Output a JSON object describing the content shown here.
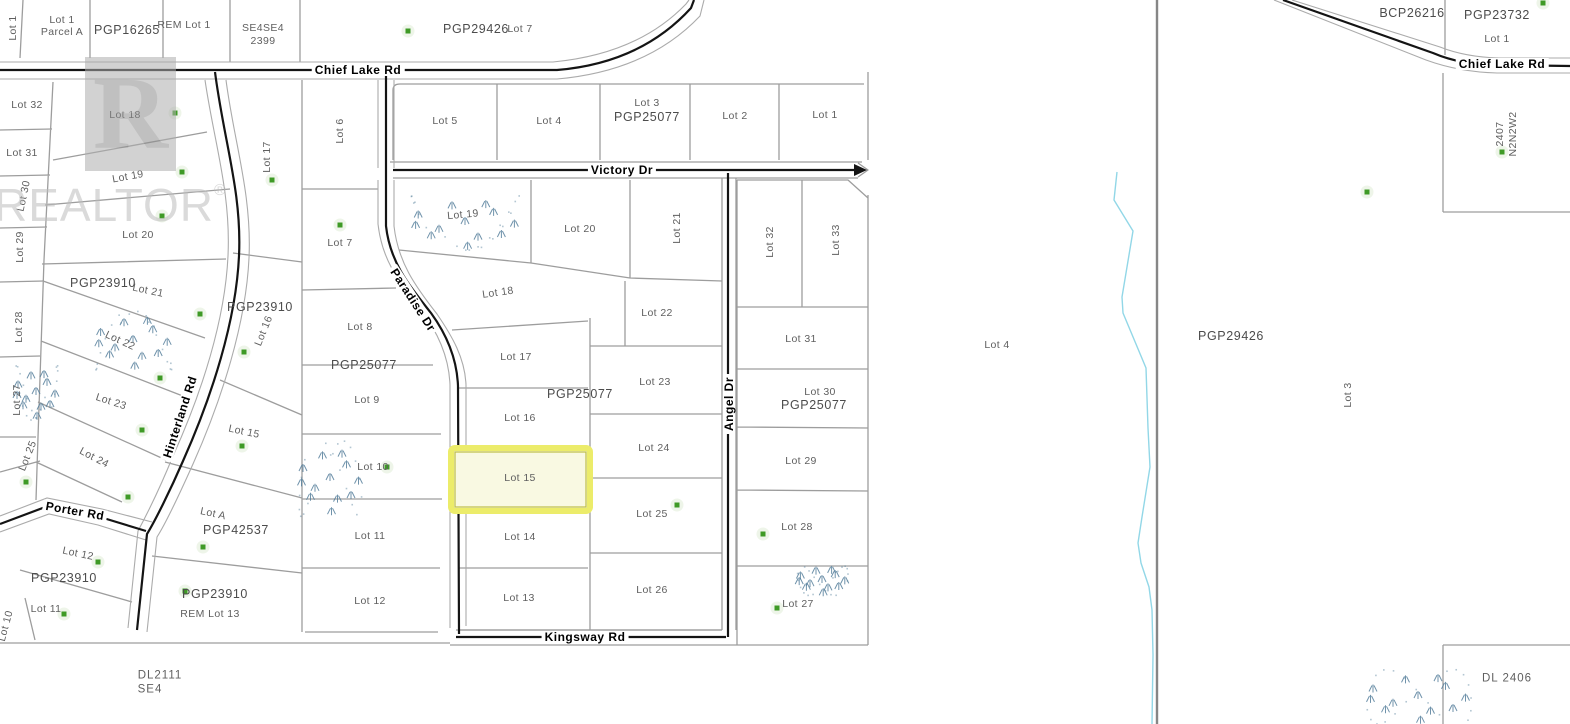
{
  "watermark": {
    "logo_letter": "R",
    "text": "REALTOR",
    "registered": "®"
  },
  "colors": {
    "line": "#9d9d9d",
    "casing": "#ababab",
    "road": "#141414",
    "creek": "#92d7e7",
    "tree": "#3f9a26",
    "tree_halo": "#e7f1df",
    "marsh": "#57809c",
    "label": "#5f5f5f",
    "plan_label": "#4c4c4c",
    "highlight_fill": "#f9f9e2",
    "highlight_border": "#ecec6a",
    "highlight_inner": "#bdbd45",
    "boundary": "#868686"
  },
  "map_features": {
    "highlight": {
      "x": 451,
      "y": 448,
      "w": 139,
      "h": 63
    },
    "creek": [
      [
        1117,
        172
      ],
      [
        1114,
        200
      ],
      [
        1133,
        231
      ],
      [
        1122,
        297
      ],
      [
        1123,
        313
      ],
      [
        1146,
        368
      ],
      [
        1148,
        428
      ],
      [
        1150,
        467
      ],
      [
        1142,
        517
      ],
      [
        1138,
        543
      ],
      [
        1141,
        563
      ],
      [
        1149,
        587
      ],
      [
        1152,
        610
      ],
      [
        1153,
        655
      ],
      [
        1152,
        724
      ]
    ],
    "trees": [
      [
        408,
        31
      ],
      [
        175,
        113
      ],
      [
        182,
        172
      ],
      [
        162,
        216
      ],
      [
        272,
        180
      ],
      [
        340,
        225
      ],
      [
        200,
        314
      ],
      [
        244,
        352
      ],
      [
        160,
        378
      ],
      [
        142,
        430
      ],
      [
        242,
        446
      ],
      [
        387,
        467
      ],
      [
        26,
        482
      ],
      [
        128,
        497
      ],
      [
        98,
        562
      ],
      [
        203,
        547
      ],
      [
        185,
        591
      ],
      [
        64,
        614
      ],
      [
        677,
        505
      ],
      [
        763,
        534
      ],
      [
        777,
        608
      ],
      [
        1367,
        192
      ],
      [
        1502,
        152
      ],
      [
        1543,
        3
      ]
    ],
    "marsh_clusters": [
      {
        "cx": 465,
        "cy": 222,
        "rx": 52,
        "ry": 26
      },
      {
        "cx": 133,
        "cy": 340,
        "rx": 36,
        "ry": 28
      },
      {
        "cx": 36,
        "cy": 392,
        "rx": 20,
        "ry": 26
      },
      {
        "cx": 330,
        "cy": 478,
        "rx": 30,
        "ry": 36
      },
      {
        "cx": 822,
        "cy": 580,
        "rx": 24,
        "ry": 14
      },
      {
        "cx": 1418,
        "cy": 696,
        "rx": 50,
        "ry": 26
      }
    ]
  },
  "labels": [
    {
      "text": "Lot 1",
      "x": 13,
      "y": 28,
      "rot": -90
    },
    {
      "text": "Lot 1",
      "x": 62,
      "y": 20
    },
    {
      "text": "Parcel A",
      "x": 62,
      "y": 32
    },
    {
      "text": "PGP16265",
      "x": 127,
      "y": 30,
      "kind": "plan"
    },
    {
      "text": "REM Lot 1",
      "x": 184,
      "y": 25
    },
    {
      "text": "SE4SE4",
      "x": 263,
      "y": 28
    },
    {
      "text": "2399",
      "x": 263,
      "y": 41
    },
    {
      "text": "PGP29426",
      "x": 476,
      "y": 29,
      "kind": "plan"
    },
    {
      "text": "Lot 7",
      "x": 520,
      "y": 29
    },
    {
      "text": "Chief Lake Rd",
      "x": 358,
      "y": 70,
      "kind": "road"
    },
    {
      "text": "Lot 5",
      "x": 445,
      "y": 121
    },
    {
      "text": "Lot 4",
      "x": 549,
      "y": 121
    },
    {
      "text": "Lot 3",
      "x": 647,
      "y": 103
    },
    {
      "text": "PGP25077",
      "x": 647,
      "y": 117,
      "kind": "plan"
    },
    {
      "text": "Lot 2",
      "x": 735,
      "y": 116
    },
    {
      "text": "Lot 1",
      "x": 825,
      "y": 115
    },
    {
      "text": "Victory Dr",
      "x": 622,
      "y": 170,
      "kind": "road"
    },
    {
      "text": "Lot 32",
      "x": 27,
      "y": 105
    },
    {
      "text": "Lot 18",
      "x": 125,
      "y": 115
    },
    {
      "text": "Lot 31",
      "x": 22,
      "y": 153
    },
    {
      "text": "Lot 17",
      "x": 267,
      "y": 157,
      "rot": -90
    },
    {
      "text": "Lot 6",
      "x": 340,
      "y": 131,
      "rot": -90
    },
    {
      "text": "Lot 19",
      "x": 128,
      "y": 177,
      "rot": -10
    },
    {
      "text": "Lot 30",
      "x": 24,
      "y": 196,
      "rot": -78
    },
    {
      "text": "Lot 20",
      "x": 138,
      "y": 235
    },
    {
      "text": "Lot 7",
      "x": 340,
      "y": 243
    },
    {
      "text": "Lot 29",
      "x": 20,
      "y": 247,
      "rot": -90
    },
    {
      "text": "PGP23910",
      "x": 103,
      "y": 283,
      "kind": "plan"
    },
    {
      "text": "Lot 21",
      "x": 148,
      "y": 291,
      "rot": 12
    },
    {
      "text": "PGP23910",
      "x": 260,
      "y": 307,
      "kind": "plan"
    },
    {
      "text": "Lot 16",
      "x": 264,
      "y": 331,
      "rot": -68
    },
    {
      "text": "Lot 28",
      "x": 19,
      "y": 327,
      "rot": -90
    },
    {
      "text": "Lot 22",
      "x": 120,
      "y": 341,
      "rot": 25
    },
    {
      "text": "Lot 8",
      "x": 360,
      "y": 327
    },
    {
      "text": "PGP25077",
      "x": 364,
      "y": 365,
      "kind": "plan"
    },
    {
      "text": "Lot 27",
      "x": 17,
      "y": 400,
      "rot": -90
    },
    {
      "text": "Lot 23",
      "x": 111,
      "y": 402,
      "rot": 18
    },
    {
      "text": "Lot 9",
      "x": 367,
      "y": 400
    },
    {
      "text": "Hinterland Rd",
      "x": 180,
      "y": 417,
      "rot": -72,
      "kind": "road"
    },
    {
      "text": "Lot 15",
      "x": 244,
      "y": 432,
      "rot": 12
    },
    {
      "text": "Lot 24",
      "x": 94,
      "y": 458,
      "rot": 28
    },
    {
      "text": "Lot 10",
      "x": 373,
      "y": 467
    },
    {
      "text": "Lot 25",
      "x": 28,
      "y": 456,
      "rot": -68
    },
    {
      "text": "Porter Rd",
      "x": 75,
      "y": 511,
      "rot": 10,
      "kind": "road"
    },
    {
      "text": "Lot A",
      "x": 213,
      "y": 514,
      "rot": 12
    },
    {
      "text": "PGP42537",
      "x": 236,
      "y": 530,
      "kind": "plan"
    },
    {
      "text": "Lot 12",
      "x": 78,
      "y": 554,
      "rot": 12
    },
    {
      "text": "PGP23910",
      "x": 64,
      "y": 578,
      "kind": "plan"
    },
    {
      "text": "Lot 11",
      "x": 46,
      "y": 609
    },
    {
      "text": "Lot 10",
      "x": 6,
      "y": 626,
      "rot": -75
    },
    {
      "text": "PGP23910",
      "x": 215,
      "y": 594,
      "kind": "plan"
    },
    {
      "text": "REM Lot 13",
      "x": 210,
      "y": 614
    },
    {
      "text": "DL2111",
      "x": 160,
      "y": 676,
      "kind": "area"
    },
    {
      "text": "SE4",
      "x": 150,
      "y": 690,
      "kind": "area"
    },
    {
      "text": "Lot 11",
      "x": 370,
      "y": 536
    },
    {
      "text": "Lot 12",
      "x": 370,
      "y": 601
    },
    {
      "text": "Kingsway Rd",
      "x": 585,
      "y": 637,
      "kind": "road"
    },
    {
      "text": "Paradise Dr",
      "x": 413,
      "y": 300,
      "rot": 57,
      "kind": "road"
    },
    {
      "text": "Lot 19",
      "x": 463,
      "y": 215,
      "rot": -5
    },
    {
      "text": "Lot 20",
      "x": 580,
      "y": 229
    },
    {
      "text": "Lot 21",
      "x": 677,
      "y": 228,
      "rot": -90
    },
    {
      "text": "Lot 32",
      "x": 770,
      "y": 242,
      "rot": -90
    },
    {
      "text": "Lot 33",
      "x": 836,
      "y": 240,
      "rot": -90
    },
    {
      "text": "Lot 18",
      "x": 498,
      "y": 293,
      "rot": -8
    },
    {
      "text": "Lot 22",
      "x": 657,
      "y": 313
    },
    {
      "text": "Lot 17",
      "x": 516,
      "y": 357
    },
    {
      "text": "Lot 23",
      "x": 655,
      "y": 382
    },
    {
      "text": "PGP25077",
      "x": 580,
      "y": 394,
      "kind": "plan"
    },
    {
      "text": "Lot 16",
      "x": 520,
      "y": 418
    },
    {
      "text": "Angel Dr",
      "x": 729,
      "y": 404,
      "rot": -90,
      "kind": "road"
    },
    {
      "text": "Lot 31",
      "x": 801,
      "y": 339
    },
    {
      "text": "Lot 30",
      "x": 820,
      "y": 392
    },
    {
      "text": "PGP25077",
      "x": 814,
      "y": 405,
      "kind": "plan"
    },
    {
      "text": "Lot 24",
      "x": 654,
      "y": 448
    },
    {
      "text": "Lot 15",
      "x": 520,
      "y": 478
    },
    {
      "text": "Lot 29",
      "x": 801,
      "y": 461
    },
    {
      "text": "Lot 25",
      "x": 652,
      "y": 514
    },
    {
      "text": "Lot 28",
      "x": 797,
      "y": 527
    },
    {
      "text": "Lot 14",
      "x": 520,
      "y": 537
    },
    {
      "text": "Lot 26",
      "x": 652,
      "y": 590
    },
    {
      "text": "Lot 27",
      "x": 798,
      "y": 604
    },
    {
      "text": "Lot 13",
      "x": 519,
      "y": 598
    },
    {
      "text": "BCP26216",
      "x": 1412,
      "y": 13,
      "kind": "plan"
    },
    {
      "text": "PGP23732",
      "x": 1497,
      "y": 15,
      "kind": "plan"
    },
    {
      "text": "Lot 1",
      "x": 1497,
      "y": 39
    },
    {
      "text": "Chief Lake Rd",
      "x": 1502,
      "y": 64,
      "kind": "road"
    },
    {
      "text": "2407",
      "x": 1500,
      "y": 134,
      "rot": -90
    },
    {
      "text": "N2N2W2",
      "x": 1513,
      "y": 134,
      "rot": -90
    },
    {
      "text": "Lot 4",
      "x": 997,
      "y": 345
    },
    {
      "text": "PGP29426",
      "x": 1231,
      "y": 336,
      "kind": "plan"
    },
    {
      "text": "Lot 3",
      "x": 1348,
      "y": 395,
      "rot": -90
    },
    {
      "text": "DL 2406",
      "x": 1507,
      "y": 679,
      "kind": "area"
    }
  ]
}
